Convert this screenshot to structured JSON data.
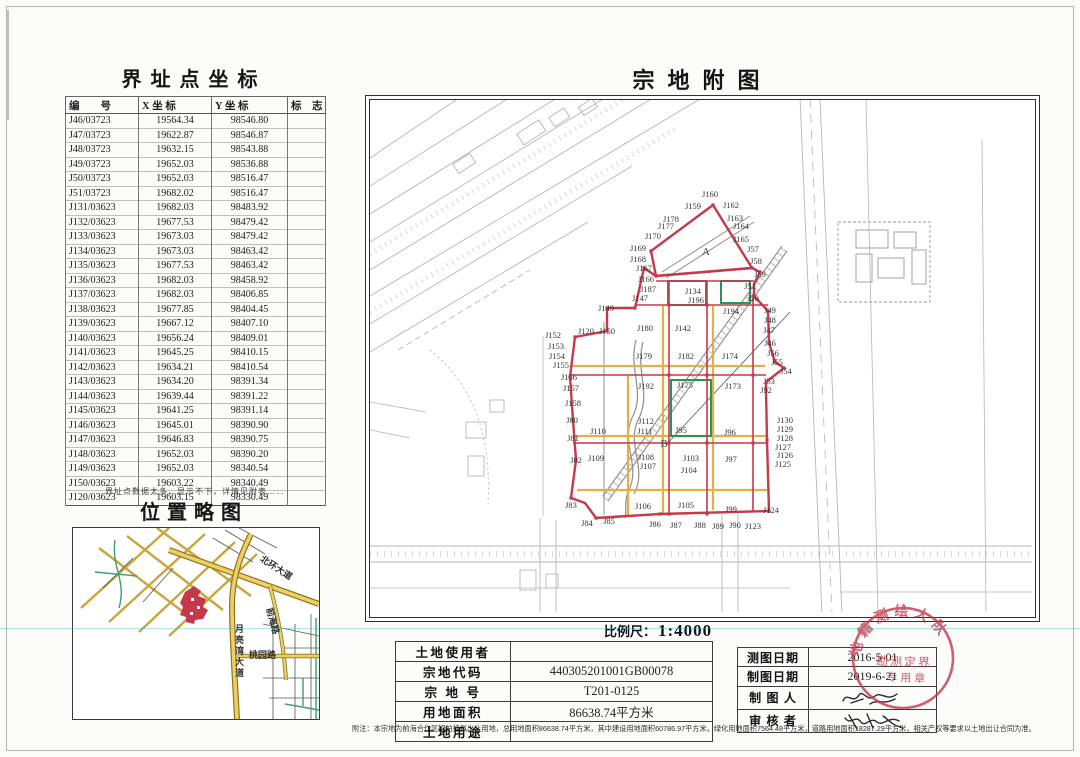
{
  "coord_table": {
    "title": "界址点坐标",
    "headers": [
      "编　　号",
      "X 坐 标",
      "Y 坐 标",
      "标　志"
    ],
    "rows": [
      [
        "J46/03723",
        "19564.34",
        "98546.80",
        ""
      ],
      [
        "J47/03723",
        "19622.87",
        "98546.87",
        ""
      ],
      [
        "J48/03723",
        "19632.15",
        "98543.88",
        ""
      ],
      [
        "J49/03723",
        "19652.03",
        "98536.88",
        ""
      ],
      [
        "J50/03723",
        "19652.03",
        "98516.47",
        ""
      ],
      [
        "J51/03723",
        "19682.02",
        "98516.47",
        ""
      ],
      [
        "J131/03623",
        "19682.03",
        "98483.92",
        ""
      ],
      [
        "J132/03623",
        "19677.53",
        "98479.42",
        ""
      ],
      [
        "J133/03623",
        "19673.03",
        "98479.42",
        ""
      ],
      [
        "J134/03623",
        "19673.03",
        "98463.42",
        ""
      ],
      [
        "J135/03623",
        "19677.53",
        "98463.42",
        ""
      ],
      [
        "J136/03623",
        "19682.03",
        "98458.92",
        ""
      ],
      [
        "J137/03623",
        "19682.03",
        "98406.85",
        ""
      ],
      [
        "J138/03623",
        "19677.85",
        "98404.45",
        ""
      ],
      [
        "J139/03623",
        "19667.12",
        "98407.10",
        ""
      ],
      [
        "J140/03623",
        "19656.24",
        "98409.01",
        ""
      ],
      [
        "J141/03623",
        "19645.25",
        "98410.15",
        ""
      ],
      [
        "J142/03623",
        "19634.21",
        "98410.54",
        ""
      ],
      [
        "J143/03623",
        "19634.20",
        "98391.34",
        ""
      ],
      [
        "J144/03623",
        "19639.44",
        "98391.22",
        ""
      ],
      [
        "J145/03623",
        "19641.25",
        "98391.14",
        ""
      ],
      [
        "J146/03623",
        "19645.01",
        "98390.90",
        ""
      ],
      [
        "J147/03623",
        "19646.83",
        "98390.75",
        ""
      ],
      [
        "J148/03623",
        "19652.03",
        "98390.20",
        ""
      ],
      [
        "J149/03623",
        "19652.03",
        "98340.54",
        ""
      ],
      [
        "J150/03623",
        "19603.22",
        "98340.49",
        ""
      ],
      [
        "J120/03623",
        "19603.15",
        "98330.49",
        ""
      ]
    ],
    "note": "界址点数据太多，显示不下，详情见附表……"
  },
  "location_map": {
    "title": "位置略图",
    "road_labels": [
      {
        "t": "北环大道",
        "x": 192,
        "y": 24,
        "rot": 33,
        "vert": false
      },
      {
        "t": "前海路",
        "x": 203,
        "y": 78,
        "rot": 75,
        "vert": false
      },
      {
        "t": "月亮湾大道",
        "x": 160,
        "y": 96,
        "rot": 0,
        "vert": true
      },
      {
        "t": "桃园路",
        "x": 176,
        "y": 120,
        "rot": 0,
        "vert": false
      }
    ]
  },
  "parcel_map": {
    "title": "宗地附图",
    "scale_label": "比例尺：",
    "scale_value": "1:4000",
    "zone_labels": [
      {
        "t": "A",
        "x": 336,
        "y": 152
      },
      {
        "t": "B",
        "x": 294,
        "y": 344
      }
    ],
    "point_labels": [
      {
        "t": "J159",
        "x": 323,
        "y": 106
      },
      {
        "t": "J160",
        "x": 340,
        "y": 94
      },
      {
        "t": "J162",
        "x": 361,
        "y": 105
      },
      {
        "t": "J163",
        "x": 365,
        "y": 118
      },
      {
        "t": "J164",
        "x": 371,
        "y": 126
      },
      {
        "t": "J165",
        "x": 371,
        "y": 139
      },
      {
        "t": "J57",
        "x": 383,
        "y": 149
      },
      {
        "t": "J58",
        "x": 386,
        "y": 161
      },
      {
        "t": "J59",
        "x": 390,
        "y": 174
      },
      {
        "t": "J51",
        "x": 380,
        "y": 186
      },
      {
        "t": "J50",
        "x": 383,
        "y": 198
      },
      {
        "t": "J49",
        "x": 400,
        "y": 210
      },
      {
        "t": "J48",
        "x": 400,
        "y": 220
      },
      {
        "t": "J47",
        "x": 399,
        "y": 230
      },
      {
        "t": "J46",
        "x": 400,
        "y": 243
      },
      {
        "t": "J56",
        "x": 403,
        "y": 253
      },
      {
        "t": "J55",
        "x": 407,
        "y": 262
      },
      {
        "t": "J54",
        "x": 416,
        "y": 271
      },
      {
        "t": "J53",
        "x": 399,
        "y": 281
      },
      {
        "t": "J52",
        "x": 396,
        "y": 290
      },
      {
        "t": "J130",
        "x": 415,
        "y": 320
      },
      {
        "t": "J129",
        "x": 415,
        "y": 329
      },
      {
        "t": "J128",
        "x": 415,
        "y": 338
      },
      {
        "t": "J127",
        "x": 413,
        "y": 347
      },
      {
        "t": "J126",
        "x": 415,
        "y": 355
      },
      {
        "t": "J125",
        "x": 413,
        "y": 364
      },
      {
        "t": "J124",
        "x": 401,
        "y": 410
      },
      {
        "t": "J123",
        "x": 383,
        "y": 426
      },
      {
        "t": "J90",
        "x": 365,
        "y": 425
      },
      {
        "t": "J89",
        "x": 348,
        "y": 426
      },
      {
        "t": "J88",
        "x": 330,
        "y": 425
      },
      {
        "t": "J87",
        "x": 306,
        "y": 425
      },
      {
        "t": "J86",
        "x": 285,
        "y": 424
      },
      {
        "t": "J85",
        "x": 239,
        "y": 421
      },
      {
        "t": "J84",
        "x": 217,
        "y": 423
      },
      {
        "t": "J83",
        "x": 201,
        "y": 405
      },
      {
        "t": "J82",
        "x": 206,
        "y": 360
      },
      {
        "t": "J81",
        "x": 203,
        "y": 338
      },
      {
        "t": "J80",
        "x": 202,
        "y": 320
      },
      {
        "t": "J158",
        "x": 203,
        "y": 303
      },
      {
        "t": "J157",
        "x": 201,
        "y": 288
      },
      {
        "t": "J156",
        "x": 199,
        "y": 277
      },
      {
        "t": "J155",
        "x": 191,
        "y": 265
      },
      {
        "t": "J154",
        "x": 187,
        "y": 256
      },
      {
        "t": "J153",
        "x": 186,
        "y": 246
      },
      {
        "t": "J152",
        "x": 183,
        "y": 235
      },
      {
        "t": "J120",
        "x": 216,
        "y": 231
      },
      {
        "t": "J150",
        "x": 237,
        "y": 231
      },
      {
        "t": "J149",
        "x": 236,
        "y": 208
      },
      {
        "t": "J147",
        "x": 270,
        "y": 198
      },
      {
        "t": "J187",
        "x": 278,
        "y": 189
      },
      {
        "t": "J166",
        "x": 276,
        "y": 179
      },
      {
        "t": "J167",
        "x": 274,
        "y": 168
      },
      {
        "t": "J168",
        "x": 268,
        "y": 159
      },
      {
        "t": "J169",
        "x": 268,
        "y": 148
      },
      {
        "t": "J170",
        "x": 283,
        "y": 136
      },
      {
        "t": "J177",
        "x": 296,
        "y": 126
      },
      {
        "t": "J178",
        "x": 301,
        "y": 119
      },
      {
        "t": "J134",
        "x": 323,
        "y": 191
      },
      {
        "t": "J196",
        "x": 326,
        "y": 200
      },
      {
        "t": "J194",
        "x": 361,
        "y": 211
      },
      {
        "t": "J180",
        "x": 275,
        "y": 228
      },
      {
        "t": "J142",
        "x": 313,
        "y": 228
      },
      {
        "t": "J179",
        "x": 274,
        "y": 256
      },
      {
        "t": "J182",
        "x": 316,
        "y": 256
      },
      {
        "t": "J174",
        "x": 360,
        "y": 256
      },
      {
        "t": "J192",
        "x": 276,
        "y": 286
      },
      {
        "t": "J175",
        "x": 315,
        "y": 285
      },
      {
        "t": "J173",
        "x": 363,
        "y": 286
      },
      {
        "t": "J112",
        "x": 276,
        "y": 321
      },
      {
        "t": "J111",
        "x": 275,
        "y": 331
      },
      {
        "t": "J110",
        "x": 228,
        "y": 331
      },
      {
        "t": "J95",
        "x": 311,
        "y": 330
      },
      {
        "t": "J96",
        "x": 360,
        "y": 332
      },
      {
        "t": "J109",
        "x": 226,
        "y": 358
      },
      {
        "t": "J108",
        "x": 276,
        "y": 357
      },
      {
        "t": "J107",
        "x": 278,
        "y": 366
      },
      {
        "t": "J103",
        "x": 321,
        "y": 358
      },
      {
        "t": "J104",
        "x": 319,
        "y": 370
      },
      {
        "t": "J97",
        "x": 361,
        "y": 359
      },
      {
        "t": "J106",
        "x": 273,
        "y": 406
      },
      {
        "t": "J105",
        "x": 316,
        "y": 405
      },
      {
        "t": "J99",
        "x": 361,
        "y": 409
      }
    ]
  },
  "land_table": {
    "rows": [
      {
        "label": "土地使用者",
        "value": ""
      },
      {
        "label": "宗地代码",
        "value": "440305201001GB00078"
      },
      {
        "label": "宗 地 号",
        "value": "T201-0125"
      },
      {
        "label": "用地面积",
        "value": "86638.74平方米"
      },
      {
        "label": "土地用途",
        "value": ""
      }
    ]
  },
  "info_table": {
    "rows": [
      {
        "label": "测图日期",
        "value": "2016-5-01",
        "signature": false
      },
      {
        "label": "制图日期",
        "value": "2019-6-21",
        "signature": false
      },
      {
        "label": "制 图 人",
        "value": "",
        "signature": true
      },
      {
        "label": "审 核 者",
        "value": "",
        "signature": true
      }
    ]
  },
  "stamp": {
    "arc_text": "地籍测绘大队",
    "inner_line1": "勘测定界",
    "inner_line2": "专用章",
    "color": "#c5394a"
  },
  "footnote": "附注：本宗地为前海合作区招拍挂拟出让用地，总用地面积86638.74平方米，其中建设用地面积60786.97平方米，绿化用地面积7564.48平方米，道路用地面积18287.29平方米，相关产权等要求以土地出让合同为准。"
}
